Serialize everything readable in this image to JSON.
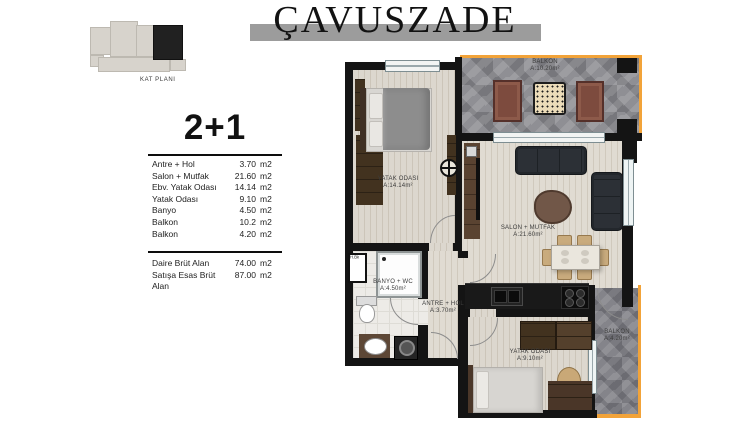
{
  "title": "ÇAVUSZADE",
  "mini_plan": {
    "caption": "KAT PLANI"
  },
  "info": {
    "type_label": "2+1",
    "rooms": [
      {
        "name": "Antre + Hol",
        "value": "3.70",
        "unit": "m2"
      },
      {
        "name": "Salon + Mutfak",
        "value": "21.60",
        "unit": "m2"
      },
      {
        "name": "Ebv. Yatak Odası",
        "value": "14.14",
        "unit": "m2"
      },
      {
        "name": "Yatak Odası",
        "value": "9.10",
        "unit": "m2"
      },
      {
        "name": "Banyo",
        "value": "4.50",
        "unit": "m2"
      },
      {
        "name": "Balkon",
        "value": "10.2",
        "unit": "m2"
      },
      {
        "name": "Balkon",
        "value": "4.20",
        "unit": "m2"
      }
    ],
    "totals": [
      {
        "name": "Daire Brüt Alan",
        "value": "74.00",
        "unit": "m2"
      },
      {
        "name": "Satışa Esas Brüt Alan",
        "value": "87.00",
        "unit": "m2"
      }
    ]
  },
  "plan": {
    "rooms": {
      "balcony_top": {
        "name": "BALKON",
        "area": "A:10.20m²"
      },
      "bedroom_master": {
        "name": "YATAK ODASI",
        "area": "A:14.14m²"
      },
      "salon": {
        "name": "SALON + MUTFAK",
        "area": "A:21.60m²"
      },
      "banyo": {
        "name": "BANYO + WC",
        "area": "A:4.50m²"
      },
      "antre": {
        "name": "ANTRE + HOL",
        "area": "A:3.70m²"
      },
      "bedroom2": {
        "name": "YATAK ODASI",
        "area": "A:9.10m²"
      },
      "balcony_right": {
        "name": "BALKON",
        "area": "A:4.20m²"
      },
      "shaft": {
        "name": "H.Bk"
      }
    }
  },
  "colors": {
    "accent_orange": "#f2a339",
    "wall_black": "#141414",
    "stone_gray": "#8f8f94",
    "title_bar_gray": "#9c9c9c",
    "sofa_dark": "#2c3036",
    "armchair_brown": "#7d4b3e"
  }
}
